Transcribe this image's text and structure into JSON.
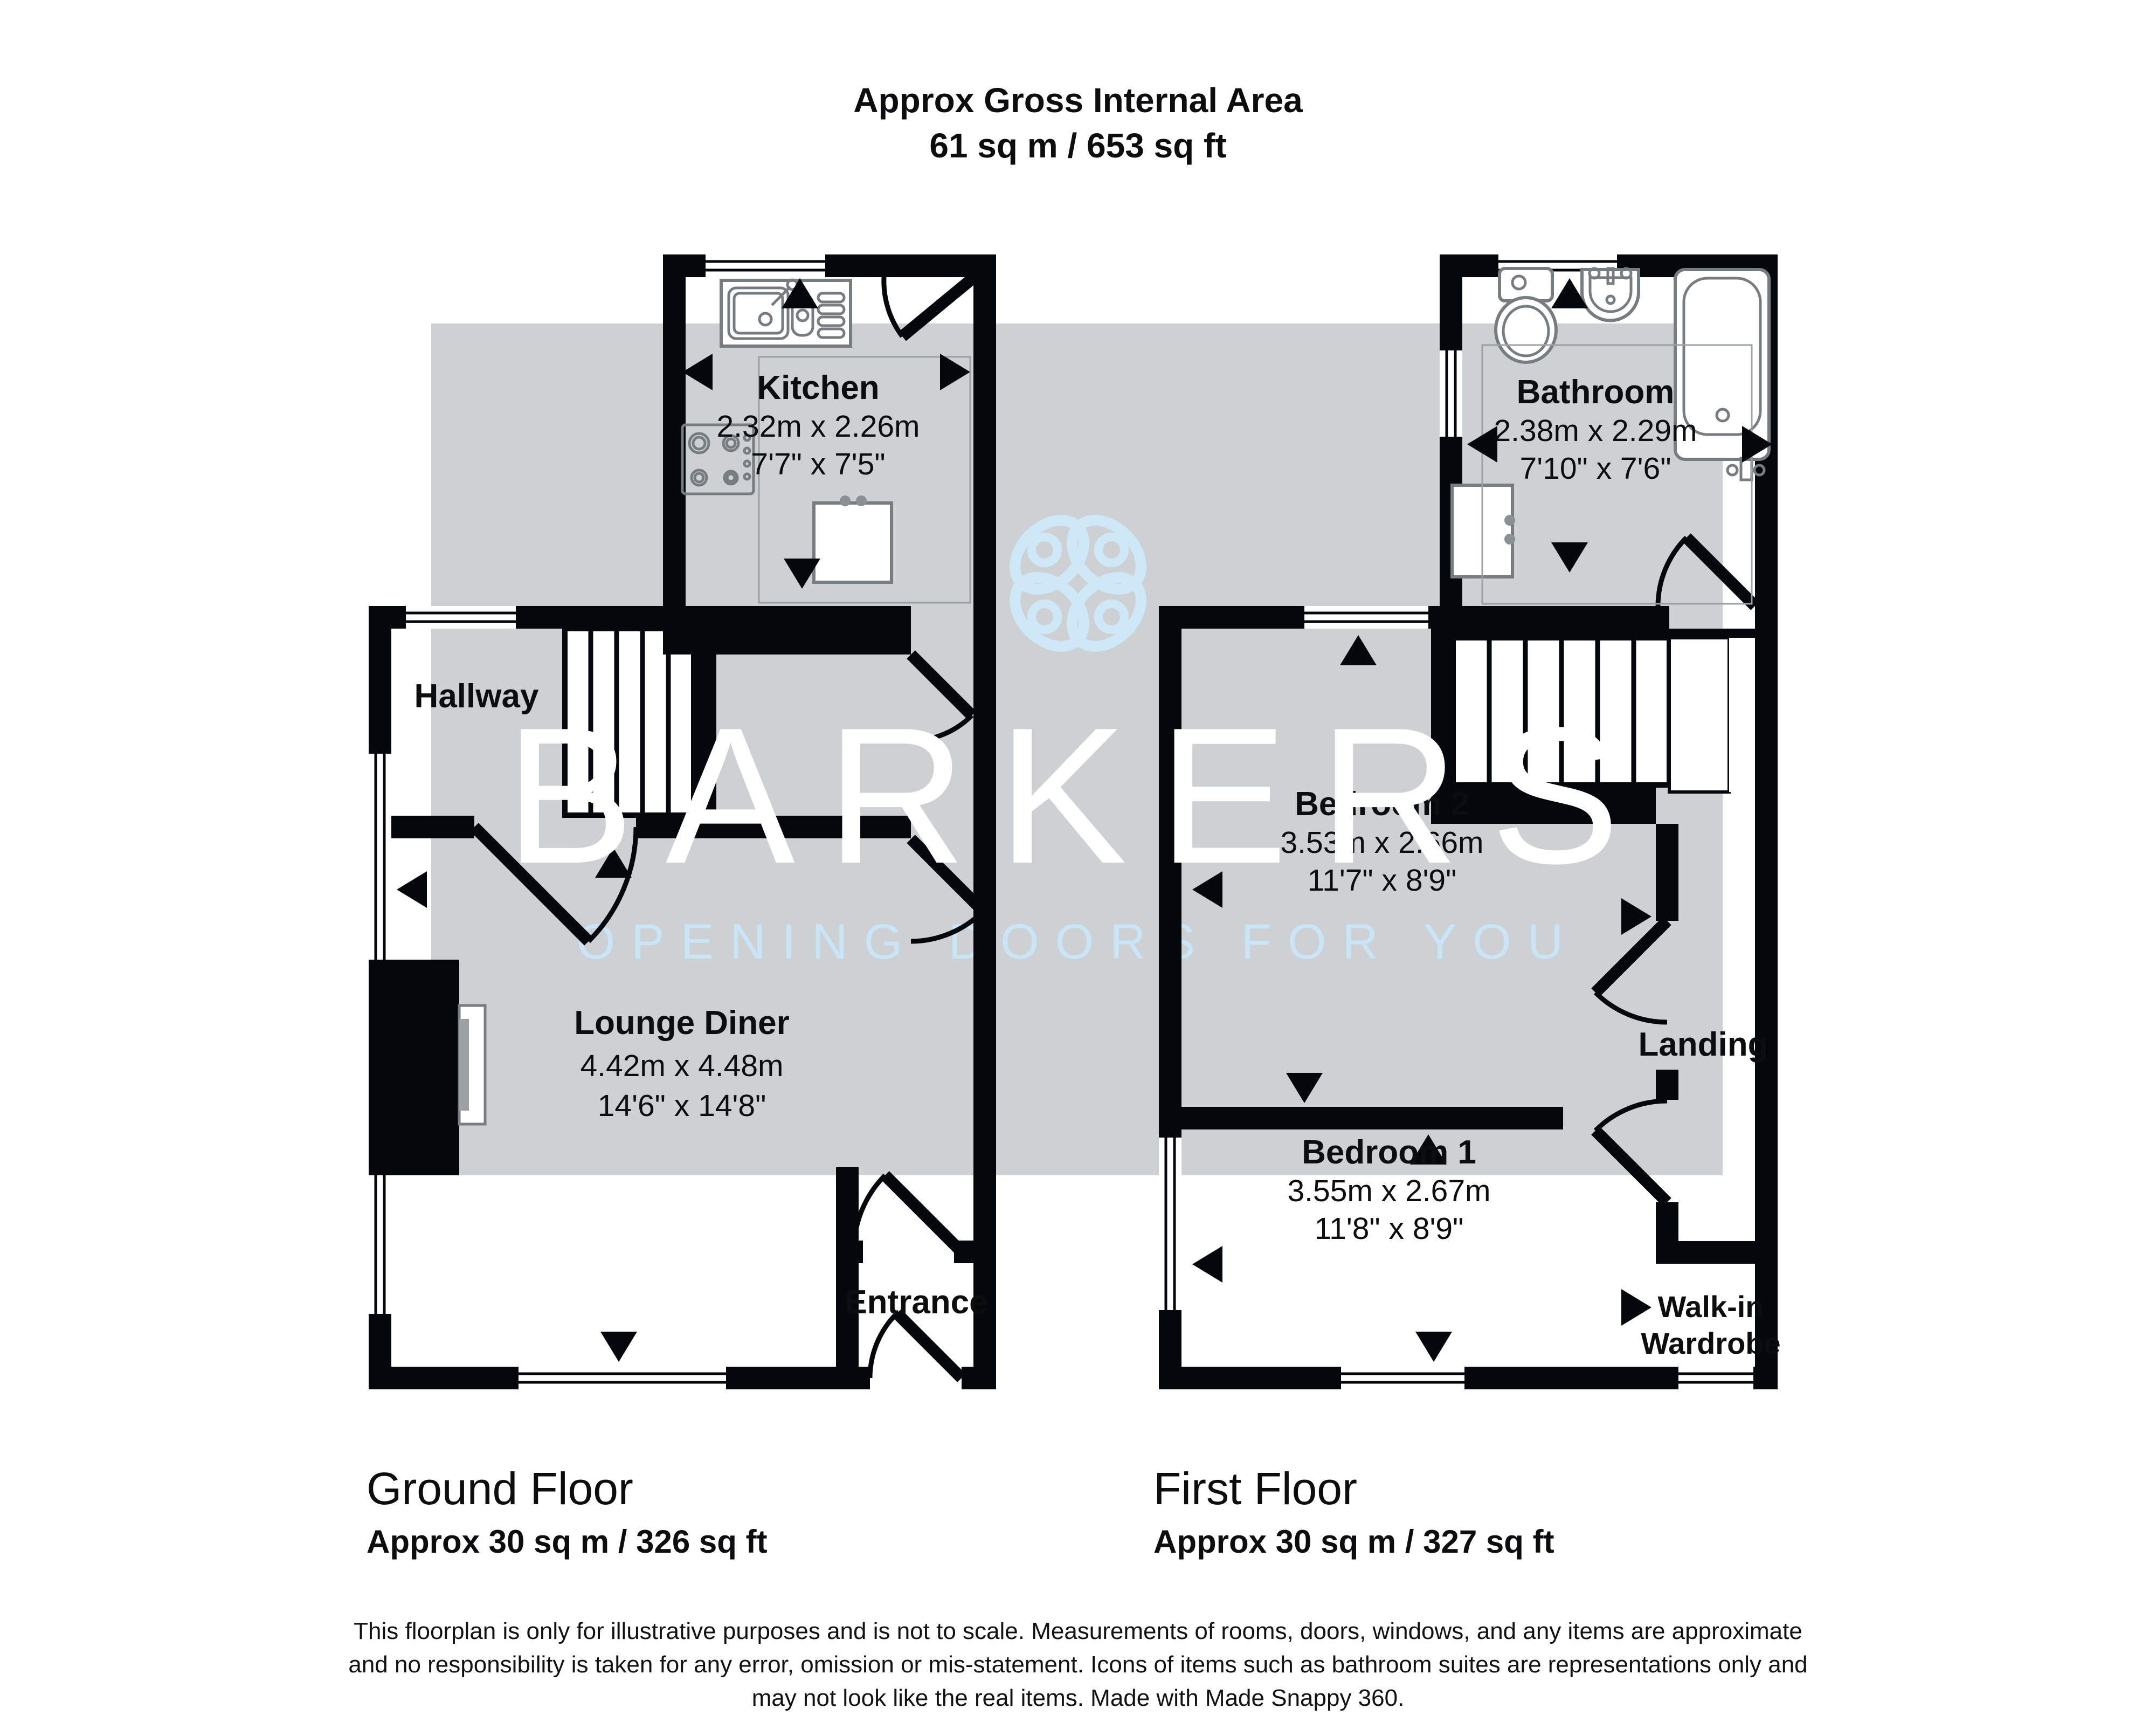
{
  "title": {
    "line1": "Approx Gross Internal Area",
    "line2": "61 sq m / 653 sq ft"
  },
  "watermark": {
    "brand": "BARKERS",
    "tagline": "OPENING DOORS FOR YOU",
    "logo_icon": "four-petal-clover-icon"
  },
  "ground_floor": {
    "label": "Ground Floor",
    "area": "Approx 30 sq m / 326 sq ft",
    "rooms": {
      "kitchen": {
        "name": "Kitchen",
        "metric": "2.32m x 2.26m",
        "imperial": "7'7\" x 7'5\""
      },
      "hallway": {
        "name": "Hallway"
      },
      "lounge": {
        "name": "Lounge Diner",
        "metric": "4.42m x 4.48m",
        "imperial": "14'6\" x 14'8\""
      },
      "entrance": {
        "name": "Entrance"
      }
    }
  },
  "first_floor": {
    "label": "First Floor",
    "area": "Approx 30 sq m / 327 sq ft",
    "rooms": {
      "bathroom": {
        "name": "Bathroom",
        "metric": "2.38m x 2.29m",
        "imperial": "7'10\" x 7'6\""
      },
      "bedroom2": {
        "name": "Bedroom 2",
        "metric": "3.53m x 2.66m",
        "imperial": "11'7\" x 8'9\""
      },
      "landing": {
        "name": "Landing"
      },
      "bedroom1": {
        "name": "Bedroom 1",
        "metric": "3.55m x 2.67m",
        "imperial": "11'8\" x 8'9\""
      },
      "wardrobe": {
        "line1": "Walk-in",
        "line2": "Wardrobe"
      }
    }
  },
  "disclaimer": {
    "line1": "This floorplan is only for illustrative purposes and is not to scale. Measurements of rooms, doors, windows, and any items are approximate",
    "line2": "and no responsibility is taken for any error, omission or mis-statement. Icons of items such as bathroom suites are representations only and",
    "line3": "may not look like the real items. Made with Made Snappy 360."
  },
  "colors": {
    "wall": "#04070b",
    "watermark_gray": "#ced1d4",
    "watermark_blue": "#c9e5f7",
    "brand_white": "#ffffff",
    "background": "#ffffff"
  }
}
